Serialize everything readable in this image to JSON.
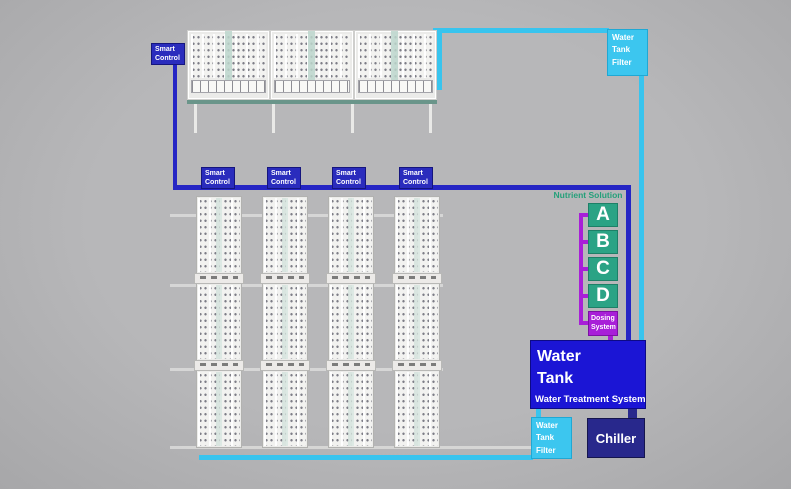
{
  "top_section": {
    "smart_control_label": "Smart Control",
    "water_tank_filter_label": "Water Tank Filter"
  },
  "grow_racks": {
    "smart_controls": [
      "Smart Control",
      "Smart Control",
      "Smart Control",
      "Smart Control"
    ]
  },
  "nutrient_solution": {
    "title": "Nutrient Solution",
    "tanks": [
      "A",
      "B",
      "C",
      "D"
    ],
    "dosing_system_label": "Dosing System"
  },
  "water_system": {
    "water_tank_label": "Water\nTank",
    "treatment_label": "Water Treatment System",
    "filter_label": "Water Tank Filter",
    "chiller_label": "Chiller"
  },
  "colors": {
    "background_gray": "#b5b5b7",
    "control_blue": "#2525c4",
    "water_tank_blue": "#1b15d5",
    "chiller_navy": "#28288c",
    "pipe_cyan": "#38c4ee",
    "nutrient_green": "#2ba385",
    "dosing_magenta": "#a81fd8"
  }
}
